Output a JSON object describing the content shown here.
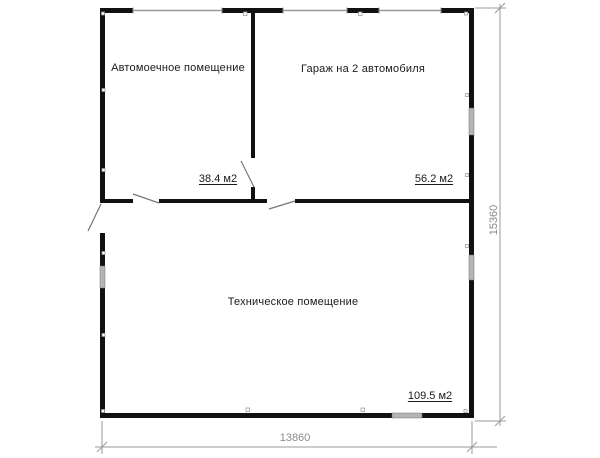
{
  "plan": {
    "type": "floor-plan",
    "rooms": [
      {
        "name": "Автомоечное помещение",
        "area": "38.4 м2"
      },
      {
        "name": "Гараж на 2 автомобиля",
        "area": "56.2 м2"
      },
      {
        "name": "Техническое помещение",
        "area": "109.5 м2"
      }
    ],
    "dimensions": {
      "width": "13860",
      "height": "15360"
    },
    "colors": {
      "wall": "#111111",
      "window_fill": "#b4b4b4",
      "window_line": "#999999",
      "door_swing": "#777777",
      "dimension_line": "#9a9a9a",
      "dimension_text": "#8a8a8a",
      "background": "#ffffff"
    }
  }
}
